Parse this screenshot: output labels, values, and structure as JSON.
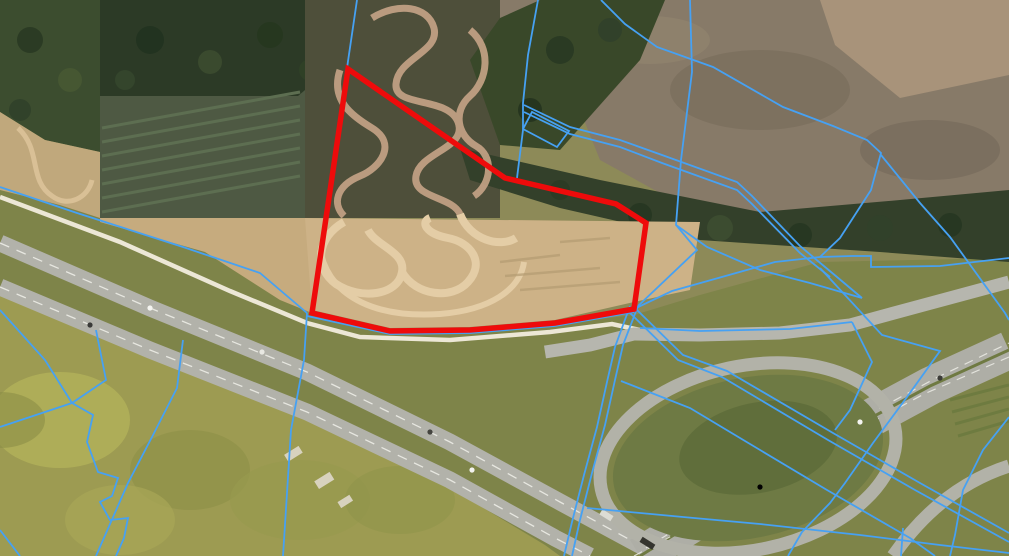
{
  "map": {
    "description": "aerial-orthophoto-with-cadastral-overlay",
    "viewport": {
      "width": 1009,
      "height": 556
    },
    "colors": {
      "selected_parcel_stroke": "#ee0b0b",
      "cadastral_stroke": "#46a1f3",
      "road_gray": "#b2b2aa",
      "grass_green": "#7e8449",
      "dirt_tan": "#cdb287",
      "forest_dark": "#33402a"
    },
    "layers": {
      "selected_parcel": {
        "label": "highlighted-parcel-outline",
        "stroke_width": 5.5,
        "points": [
          [
            348,
            69
          ],
          [
            505,
            178
          ],
          [
            616,
            204
          ],
          [
            646,
            223
          ],
          [
            634,
            309
          ],
          [
            555,
            323
          ],
          [
            470,
            330
          ],
          [
            390,
            331
          ],
          [
            312,
            313
          ]
        ]
      },
      "cadastral_lines": {
        "label": "parcel-boundaries",
        "stroke_width": 1.8,
        "polylines": [
          [
            [
              357,
              0
            ],
            [
              347,
              68
            ]
          ],
          [
            [
              307,
              313
            ],
            [
              304,
              360
            ],
            [
              291,
              430
            ],
            [
              283,
              556
            ]
          ],
          [
            [
              0,
              187
            ],
            [
              77,
              213
            ],
            [
              183,
              247
            ],
            [
              260,
              273
            ],
            [
              307,
              313
            ]
          ],
          [
            [
              307,
              316
            ],
            [
              390,
              334
            ],
            [
              470,
              333
            ],
            [
              555,
              326
            ],
            [
              634,
              312
            ]
          ],
          [
            [
              634,
              309
            ],
            [
              672,
              291
            ],
            [
              775,
              262
            ],
            [
              820,
              257
            ],
            [
              852,
              256
            ],
            [
              871,
              256
            ],
            [
              871,
              267
            ],
            [
              940,
              266
            ],
            [
              1009,
              258
            ]
          ],
          [
            [
              601,
              0
            ],
            [
              625,
              24
            ],
            [
              657,
              47
            ],
            [
              713,
              67
            ],
            [
              783,
              107
            ],
            [
              833,
              126
            ],
            [
              867,
              140
            ],
            [
              881,
              153
            ],
            [
              871,
              190
            ],
            [
              840,
              238
            ],
            [
              820,
              257
            ]
          ],
          [
            [
              690,
              0
            ],
            [
              692,
              72
            ],
            [
              681,
              160
            ],
            [
              676,
              225
            ],
            [
              697,
              250
            ],
            [
              638,
              306
            ]
          ],
          [
            [
              524,
              105
            ],
            [
              570,
              127
            ],
            [
              620,
              140
            ],
            [
              662,
              155
            ],
            [
              737,
              182
            ],
            [
              752,
              196
            ],
            [
              800,
              246
            ],
            [
              837,
              277
            ],
            [
              862,
              298
            ]
          ],
          [
            [
              524,
              112
            ],
            [
              570,
              134
            ],
            [
              620,
              147
            ],
            [
              662,
              163
            ],
            [
              737,
              190
            ],
            [
              752,
              204
            ],
            [
              800,
              253
            ],
            [
              830,
              277
            ]
          ],
          [
            [
              538,
              0
            ],
            [
              528,
              55
            ],
            [
              523,
              103
            ],
            [
              523,
              130
            ],
            [
              517,
              178
            ]
          ],
          [
            [
              523,
              129
            ],
            [
              557,
              147
            ],
            [
              569,
              131
            ],
            [
              532,
              112
            ],
            [
              523,
              129
            ]
          ],
          [
            [
              881,
              155
            ],
            [
              920,
              203
            ],
            [
              950,
              237
            ],
            [
              1005,
              313
            ],
            [
              1009,
              320
            ]
          ],
          [
            [
              676,
              225
            ],
            [
              707,
              247
            ],
            [
              760,
              270
            ],
            [
              810,
              283
            ],
            [
              862,
              298
            ]
          ],
          [
            [
              638,
              306
            ],
            [
              623,
              345
            ],
            [
              615,
              380
            ],
            [
              605,
              425
            ],
            [
              592,
              473
            ],
            [
              580,
              520
            ],
            [
              572,
              556
            ]
          ],
          [
            [
              630,
              306
            ],
            [
              615,
              347
            ],
            [
              607,
              382
            ],
            [
              597,
              427
            ],
            [
              584,
              475
            ],
            [
              572,
              522
            ],
            [
              564,
              556
            ]
          ],
          [
            [
              621,
              381
            ],
            [
              690,
              408
            ],
            [
              740,
              438
            ],
            [
              827,
              490
            ],
            [
              910,
              538
            ],
            [
              935,
              556
            ]
          ],
          [
            [
              637,
              310
            ],
            [
              683,
              355
            ],
            [
              727,
              371
            ],
            [
              833,
              433
            ],
            [
              920,
              483
            ],
            [
              1009,
              533
            ]
          ],
          [
            [
              630,
              313
            ],
            [
              678,
              360
            ],
            [
              722,
              377
            ],
            [
              828,
              440
            ],
            [
              915,
              490
            ],
            [
              1009,
              542
            ]
          ],
          [
            [
              587,
              508
            ],
            [
              683,
              517
            ],
            [
              760,
              524
            ],
            [
              860,
              535
            ],
            [
              940,
              545
            ],
            [
              1009,
              553
            ]
          ],
          [
            [
              820,
              268
            ],
            [
              882,
              335
            ],
            [
              940,
              351
            ],
            [
              907,
              397
            ],
            [
              873,
              443
            ],
            [
              845,
              483
            ],
            [
              830,
              503
            ],
            [
              802,
              532
            ],
            [
              788,
              556
            ]
          ],
          [
            [
              1009,
              417
            ],
            [
              983,
              450
            ],
            [
              963,
              490
            ],
            [
              955,
              535
            ],
            [
              950,
              556
            ]
          ],
          [
            [
              903,
              528
            ],
            [
              901,
              556
            ]
          ],
          [
            [
              0,
              310
            ],
            [
              45,
              360
            ],
            [
              72,
              403
            ]
          ],
          [
            [
              0,
              427
            ],
            [
              72,
              403
            ]
          ],
          [
            [
              72,
              403
            ],
            [
              106,
              380
            ],
            [
              96,
              330
            ]
          ],
          [
            [
              72,
              403
            ],
            [
              93,
              415
            ],
            [
              87,
              442
            ],
            [
              98,
              472
            ],
            [
              118,
              478
            ],
            [
              112,
              496
            ],
            [
              100,
              502
            ],
            [
              110,
              520
            ],
            [
              128,
              518
            ],
            [
              124,
              538
            ],
            [
              116,
              556
            ]
          ],
          [
            [
              183,
              340
            ],
            [
              177,
              388
            ],
            [
              152,
              437
            ],
            [
              128,
              483
            ],
            [
              96,
              556
            ]
          ],
          [
            [
              0,
              530
            ],
            [
              20,
              556
            ]
          ],
          [
            [
              640,
              328
            ],
            [
              700,
              331
            ],
            [
              790,
              329
            ],
            [
              852,
              322
            ]
          ],
          [
            [
              852,
              322
            ],
            [
              872,
              362
            ],
            [
              850,
              410
            ],
            [
              835,
              430
            ]
          ]
        ]
      }
    }
  }
}
